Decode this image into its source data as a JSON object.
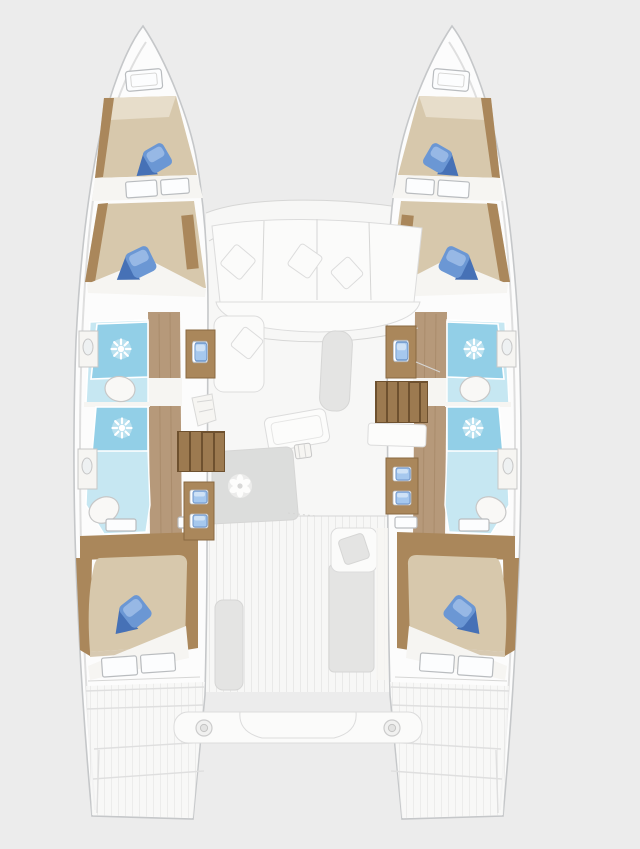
{
  "scene": {
    "description": "Top-down interior floor plan of a sailing catamaran yacht, no text labels visible",
    "background": "#ececec"
  },
  "palette": {
    "bg": "#ececec",
    "hull_fill": "#fcfcfc",
    "hull_stroke": "#c5c7c9",
    "hull_inner_line": "#dfdfdf",
    "bridge_fill": "#f7f7f6",
    "plank_line": "#e9e9e8",
    "sofa_fill": "#fbfbfa",
    "sofa_stroke": "#dcdcdc",
    "seat_gray": "#e4e4e3",
    "panel_gray": "#dcdddc",
    "table_fill": "#fcfcfb",
    "line_gray": "#d6d6d5",
    "wood": "#aa875b",
    "wood_dark": "#8a6a42",
    "wood_floor": "#b6997a",
    "wood_grain": "#9d7f5d",
    "step_dark": "#6e512f",
    "step_face": "#9c7a50",
    "mattress": "#d7c8ac",
    "mattress_shadow": "#c7b392",
    "mattress_light": "#e7ddca",
    "sheet": "#f6f5f2",
    "window_fill": "#fcfdfe",
    "window_stroke": "#b9bcbf",
    "bath_floor": "#c6e7f2",
    "shower": "#92cfe7",
    "toilet_fill": "#f9f8f6",
    "toilet_stroke": "#c7c7c7",
    "pillow_mid": "#6b97d4",
    "pillow_dark": "#4671b6",
    "pillow_light": "#9fbde8",
    "pad_blue": "#a6c8ee",
    "pad_dark": "#6d95c9"
  },
  "icons": {
    "shower_rose": "white starburst on blue shower tray",
    "stove_burner": "white petal flower on gray galley counter",
    "winch": "concentric circles on aft crossbeam bench",
    "sink": "small grid square on galley worktop"
  },
  "vessel": {
    "hulls": [
      {
        "side": "port",
        "rooms": [
          "forepeak berth",
          "forward cabin",
          "forward bathroom",
          "aft bathroom",
          "aft cabin",
          "transom steps"
        ]
      },
      {
        "side": "starboard",
        "rooms": [
          "forepeak berth",
          "forward cabin",
          "forward bathroom",
          "aft bathroom",
          "aft cabin",
          "transom steps"
        ]
      }
    ],
    "bridgedeck": {
      "areas": [
        "front sofa with scatter cushions",
        "port chaise seat",
        "starboard chart seat",
        "saloon table",
        "galley counter with burner and sink",
        "port companionway steps",
        "starboard companionway steps",
        "cockpit side benches",
        "cockpit seat cushion",
        "aft crossbeam bench with two winches"
      ]
    },
    "counts": {
      "berths": 6,
      "bathrooms": 4,
      "showers": 4,
      "toilets": 4,
      "blue_bed_pillow_sets": 6,
      "winches": 2
    }
  }
}
